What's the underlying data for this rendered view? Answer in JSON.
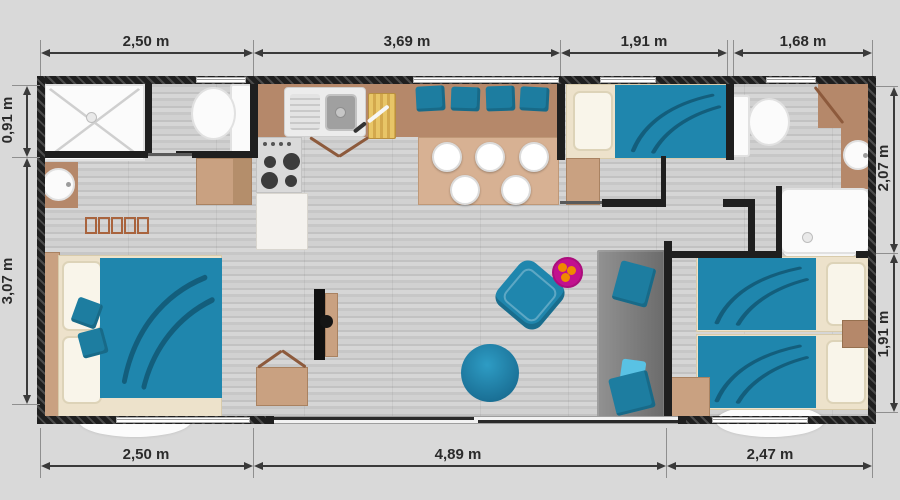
{
  "plan": {
    "type": "mobile-home-floor-plan",
    "unit": "m"
  },
  "dimensions": {
    "top": [
      "2,50 m",
      "3,69 m",
      "1,91 m",
      "1,68 m"
    ],
    "bottom": [
      "2,50 m",
      "4,89 m",
      "2,47 m"
    ],
    "left": [
      "0,91 m",
      "3,07 m"
    ],
    "right": [
      "2,07 m",
      "1,91 m"
    ]
  },
  "rooms": [
    {
      "name": "bathroom-1",
      "furniture": [
        "shower",
        "toilet"
      ]
    },
    {
      "name": "master-bedroom",
      "furniture": [
        "double-bed",
        "washbasin",
        "radiator",
        "wardrobe"
      ]
    },
    {
      "name": "kitchen",
      "furniture": [
        "double-sink",
        "hob",
        "cutting-board",
        "base-cabinet"
      ]
    },
    {
      "name": "dining-area",
      "furniture": [
        "bench-cushions",
        "dining-table",
        "plates"
      ]
    },
    {
      "name": "living-area",
      "furniture": [
        "tv-unit",
        "armchair",
        "pouf",
        "side-table",
        "sofa",
        "sideboard"
      ]
    },
    {
      "name": "bedroom-2",
      "furniture": [
        "single-bed",
        "wardrobe"
      ]
    },
    {
      "name": "bathroom-2",
      "furniture": [
        "toilet",
        "washbasin",
        "shower"
      ]
    },
    {
      "name": "bedroom-3",
      "furniture": [
        "single-bed",
        "single-bed",
        "nightstand",
        "wardrobe"
      ]
    }
  ],
  "colors": {
    "background": "#d9d9d9",
    "wall": "#1f1f1f",
    "accent_teal": "#1f86ad",
    "wood_brown": "#b5886a",
    "light_tan": "#c9a181",
    "bed_frame": "#ede2cb",
    "sofa_gray": "#7d7d7d",
    "magenta": "#c2108f",
    "orange": "#f08a00",
    "dimension_text": "#2b2b2b"
  }
}
